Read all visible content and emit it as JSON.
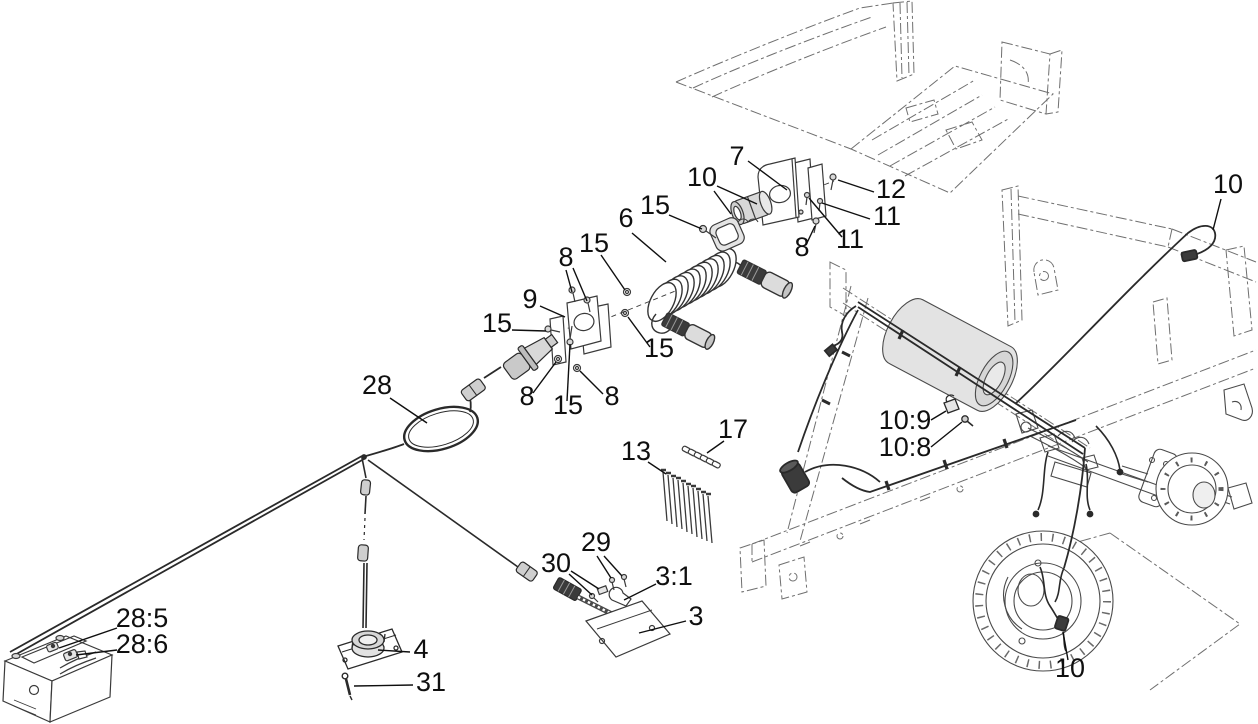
{
  "figure": {
    "kind": "exploded-parts-diagram",
    "background": "#ffffff",
    "part_line_color": "#3a3a3a",
    "phantom_line_color": "#6f6f6f",
    "harness_line_color": "#2a2a2a",
    "fill_light": "#dcdcdc",
    "fill_dark": "#3b3b3b",
    "label_color": "#0f0f0f",
    "label_font_size": 27,
    "callouts": [
      {
        "label": "7",
        "x": 737,
        "y": 165,
        "leaders": [
          [
            748,
            161,
            787,
            190
          ]
        ]
      },
      {
        "label": "10",
        "x": 702,
        "y": 186,
        "leaders": [
          [
            714,
            191,
            731,
            214
          ],
          [
            717,
            186,
            757,
            204
          ]
        ]
      },
      {
        "label": "15",
        "x": 655,
        "y": 214,
        "leaders": [
          [
            669,
            215,
            702,
            229
          ]
        ]
      },
      {
        "label": "6",
        "x": 626,
        "y": 227,
        "leaders": [
          [
            632,
            233,
            666,
            262
          ]
        ]
      },
      {
        "label": "12",
        "x": 891,
        "y": 198,
        "leaders": [
          [
            874,
            192,
            838,
            180
          ]
        ]
      },
      {
        "label": "11",
        "x": 887,
        "y": 225,
        "leaders": [
          [
            870,
            219,
            822,
            203
          ]
        ]
      },
      {
        "label": "11",
        "x": 850,
        "y": 248,
        "leaders": [
          [
            842,
            237,
            809,
            198
          ]
        ]
      },
      {
        "label": "8",
        "x": 802,
        "y": 256,
        "leaders": [
          [
            806,
            245,
            815,
            226
          ]
        ]
      },
      {
        "label": "8",
        "x": 566,
        "y": 266,
        "leaders": [
          [
            566,
            270,
            572,
            292
          ],
          [
            573,
            268,
            587,
            301
          ]
        ]
      },
      {
        "label": "15",
        "x": 594,
        "y": 252,
        "leaders": [
          [
            601,
            255,
            625,
            290
          ]
        ]
      },
      {
        "label": "9",
        "x": 530,
        "y": 308,
        "leaders": [
          [
            540,
            306,
            565,
            317
          ]
        ]
      },
      {
        "label": "15",
        "x": 497,
        "y": 332,
        "leaders": [
          [
            512,
            330,
            546,
            331
          ]
        ]
      },
      {
        "label": "15",
        "x": 659,
        "y": 357,
        "leaders": [
          [
            650,
            347,
            628,
            317
          ]
        ]
      },
      {
        "label": "8",
        "x": 527,
        "y": 405,
        "leaders": [
          [
            533,
            393,
            556,
            362
          ]
        ]
      },
      {
        "label": "15",
        "x": 568,
        "y": 414,
        "leaders": [
          [
            567,
            401,
            570,
            344
          ]
        ]
      },
      {
        "label": "8",
        "x": 612,
        "y": 405,
        "leaders": [
          [
            603,
            394,
            580,
            371
          ]
        ]
      },
      {
        "label": "28",
        "x": 377,
        "y": 394,
        "leaders": [
          [
            390,
            398,
            427,
            423
          ]
        ]
      },
      {
        "label": "10",
        "x": 1228,
        "y": 193,
        "leaders": [
          [
            1221,
            199,
            1213,
            230
          ]
        ]
      },
      {
        "label": "10:9",
        "x": 905,
        "y": 429,
        "leaders": [
          [
            931,
            420,
            946,
            411
          ]
        ]
      },
      {
        "label": "10:8",
        "x": 905,
        "y": 456,
        "leaders": [
          [
            931,
            447,
            962,
            422
          ]
        ]
      },
      {
        "label": "13",
        "x": 636,
        "y": 460,
        "leaders": [
          [
            648,
            462,
            666,
            474
          ]
        ]
      },
      {
        "label": "17",
        "x": 733,
        "y": 438,
        "leaders": [
          [
            724,
            441,
            707,
            453
          ]
        ]
      },
      {
        "label": "29",
        "x": 596,
        "y": 551,
        "leaders": [
          [
            597,
            556,
            611,
            578
          ],
          [
            604,
            556,
            622,
            576
          ]
        ]
      },
      {
        "label": "30",
        "x": 556,
        "y": 572,
        "leaders": [
          [
            569,
            574,
            592,
            595
          ],
          [
            571,
            571,
            599,
            589
          ]
        ]
      },
      {
        "label": "3:1",
        "x": 674,
        "y": 585,
        "leaders": [
          [
            656,
            584,
            624,
            600
          ]
        ]
      },
      {
        "label": "3",
        "x": 696,
        "y": 625,
        "leaders": [
          [
            686,
            621,
            639,
            633
          ]
        ]
      },
      {
        "label": "4",
        "x": 421,
        "y": 658,
        "leaders": [
          [
            410,
            652,
            378,
            650
          ]
        ]
      },
      {
        "label": "31",
        "x": 431,
        "y": 691,
        "leaders": [
          [
            413,
            685,
            354,
            686
          ]
        ]
      },
      {
        "label": "28:5",
        "x": 142,
        "y": 627,
        "leaders": [
          [
            117,
            628,
            59,
            648
          ]
        ]
      },
      {
        "label": "28:6",
        "x": 142,
        "y": 653,
        "leaders": [
          [
            117,
            650,
            76,
            655
          ]
        ]
      },
      {
        "label": "10",
        "x": 1070,
        "y": 677,
        "leaders": [
          [
            1068,
            660,
            1063,
            632
          ]
        ]
      }
    ]
  }
}
